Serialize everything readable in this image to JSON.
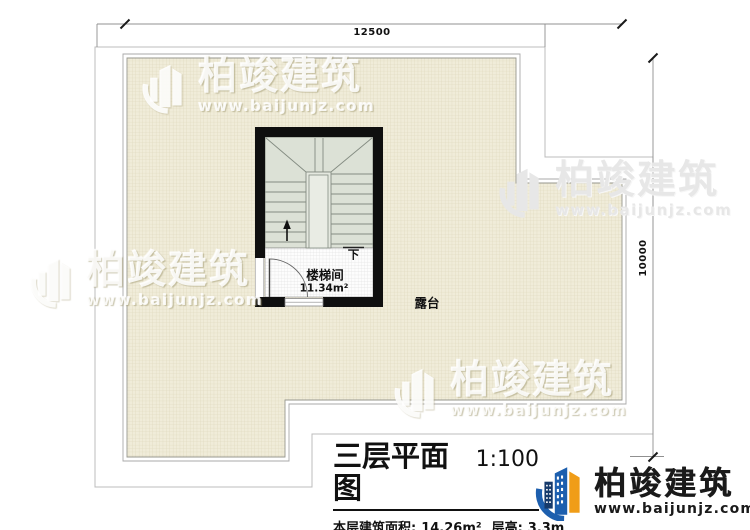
{
  "dimensions": {
    "top_width": "12500",
    "right_height": "10000"
  },
  "plan_labels": {
    "stair_room": "楼梯间",
    "stair_room_area": "11.34m²",
    "stair_direction": "下",
    "terrace": "露台"
  },
  "title_block": {
    "title": "三层平面图",
    "scale": "1:100",
    "floor_area_label": "本层建筑面积:",
    "floor_area_value": "14.26m²",
    "floor_height_label": "层高:",
    "floor_height_value": "3.3m"
  },
  "brand": {
    "name": "柏竣建筑",
    "website": "www.baijunjz.com"
  },
  "watermark": {
    "name": "柏竣建筑",
    "website": "www.baijunjz.com"
  },
  "colors": {
    "terrace_fill": "#f0ecd9",
    "terrace_grid": "#ddd6ba",
    "stair_fill": "#dce1d6",
    "stair_line": "#848c82",
    "wall_black": "#0f0f0f",
    "eave_outline": "#bcbcbc",
    "parapet_line": "#a8a8a8",
    "logo_blue": "#1d5fae",
    "logo_navy": "#163a6b",
    "logo_orange": "#f09d18",
    "text_dark": "#111111"
  }
}
